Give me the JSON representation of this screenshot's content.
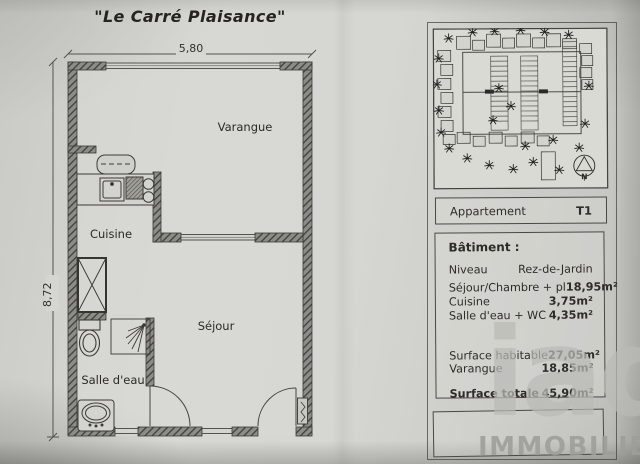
{
  "title": "\"Le Carré Plaisance\"",
  "floor_plan": {
    "width_label": "5,80",
    "height_label": "8,72",
    "room_varangue": "Varangue",
    "room_cuisine": "Cuisine",
    "room_sejour": "Séjour",
    "room_salle_deau": "Salle d'eau"
  },
  "site_plan": {
    "north_label": "N"
  },
  "info": {
    "apartment_label": "Appartement",
    "apartment_type": "T1",
    "building_label": "Bâtiment :",
    "niveau_label": "Niveau",
    "niveau_value": "Rez-de-Jardin",
    "areas": [
      {
        "label": "Séjour/Chambre + pl",
        "value": "18,95m²"
      },
      {
        "label": "Cuisine",
        "value": "3,75m²"
      },
      {
        "label": "Salle d'eau + WC",
        "value": "4,35m²"
      }
    ],
    "surfaces": [
      {
        "label": "Surface habitable",
        "value": "27,05m²"
      },
      {
        "label": "Varangue",
        "value": "18,85m²"
      }
    ],
    "total_label": "Surface totale",
    "total_value": "45,90m²"
  },
  "watermark": {
    "brand": "iad",
    "tagline": "IMMOBILIER"
  },
  "colors": {
    "paper": "#d2d2ce",
    "ink": "#2e2c29",
    "wall": "#4e4e4b",
    "watermark": "#9b9b98"
  }
}
